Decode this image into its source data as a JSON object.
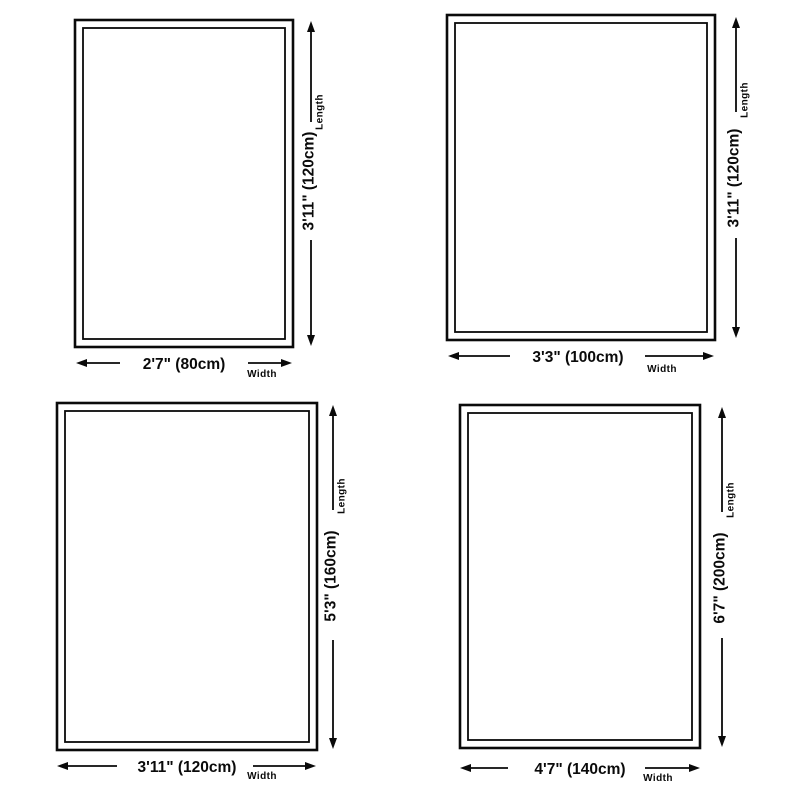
{
  "colors": {
    "background": "#ffffff",
    "line": "#0a0a0a",
    "text": "#0a0a0a"
  },
  "diagrams": [
    {
      "width_label": "2'7\" (80cm)",
      "length_label": "3'11\" (120cm)",
      "width_caption": "Width",
      "length_caption": "Length"
    },
    {
      "width_label": "3'3\" (100cm)",
      "length_label": "3'11\" (120cm)",
      "width_caption": "Width",
      "length_caption": "Length"
    },
    {
      "width_label": "3'11\" (120cm)",
      "length_label": "5'3\" (160cm)",
      "width_caption": "Width",
      "length_caption": "Length"
    },
    {
      "width_label": "4'7\" (140cm)",
      "length_label": "6'7\" (200cm)",
      "width_caption": "Width",
      "length_caption": "Length"
    }
  ]
}
